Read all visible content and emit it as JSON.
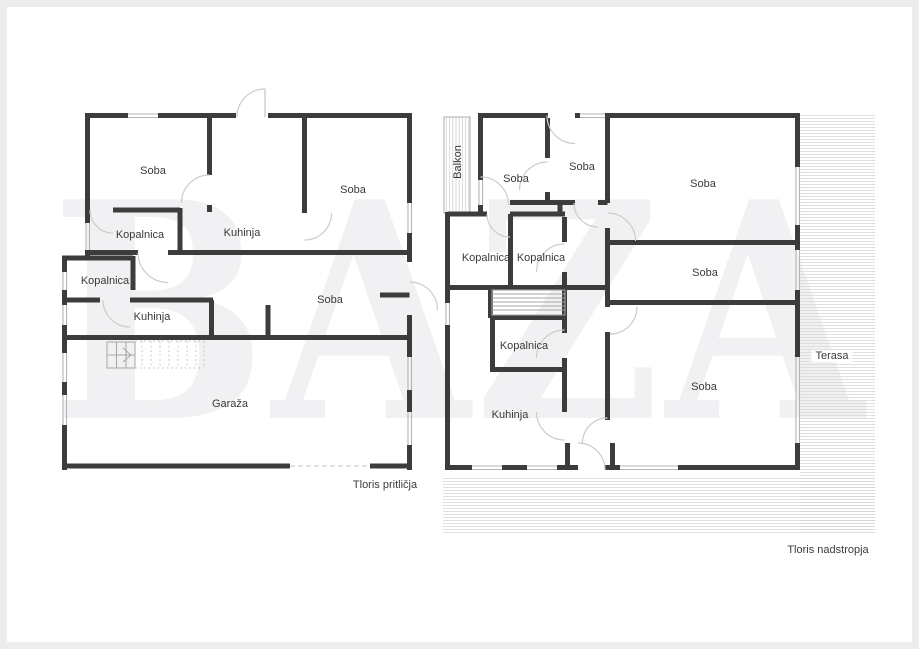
{
  "watermark": "BAZA",
  "colors": {
    "wall": "#3c3c3c",
    "thin_line": "#b4b4b4",
    "door_arc": "#cccccc",
    "hatch_line": "#d6d6d6",
    "stair_line": "#a6a6a6",
    "dotted_line": "#c9c9c9",
    "label_text": "#3a3a3a",
    "frame": "#ecedef",
    "page_background": "#ffffff",
    "watermark_color": "#f1f1f3"
  },
  "ground_floor": {
    "caption": "Tloris pritličja",
    "rooms": [
      {
        "label": "Soba"
      },
      {
        "label": "Kopalnica"
      },
      {
        "label": "Kuhinja"
      },
      {
        "label": "Soba"
      },
      {
        "label": "Kopalnica"
      },
      {
        "label": "Kuhinja"
      },
      {
        "label": "Soba"
      },
      {
        "label": "Garaža"
      }
    ]
  },
  "upper_floor": {
    "caption": "Tloris nadstropja",
    "rooms": [
      {
        "label": "Soba"
      },
      {
        "label": "Soba"
      },
      {
        "label": "Soba"
      },
      {
        "label": "Kopalnica"
      },
      {
        "label": "Kopalnica"
      },
      {
        "label": "Soba"
      },
      {
        "label": "Kopalnica"
      },
      {
        "label": "Kuhinja"
      },
      {
        "label": "Soba"
      }
    ],
    "outdoor_areas": [
      {
        "label": "Balkon"
      },
      {
        "label": "Terasa"
      }
    ]
  }
}
